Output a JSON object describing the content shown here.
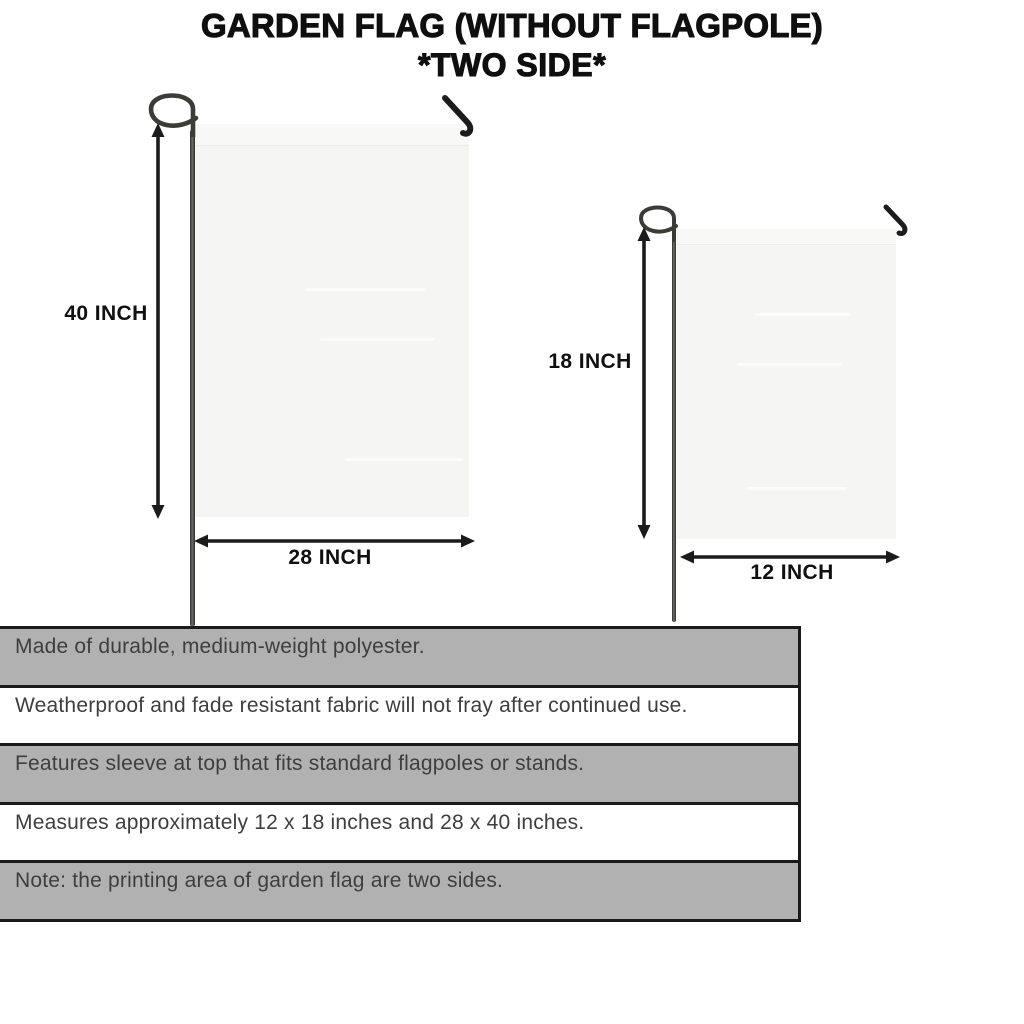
{
  "title": {
    "line1": "GARDEN FLAG (WITHOUT FLAGPOLE)",
    "line2": "*TWO SIDE*"
  },
  "flags": {
    "large": {
      "height_label": "40 INCH",
      "width_label": "28 INCH"
    },
    "small": {
      "height_label": "18 INCH",
      "width_label": "12 INCH"
    }
  },
  "features": [
    "Made of durable, medium-weight polyester.",
    "Weatherproof and fade resistant fabric will not fray after continued use.",
    "Features sleeve at top that fits standard flagpoles or stands.",
    "Measures approximately 12 x 18 inches and 28 x 40 inches.",
    "Note: the printing area of garden flag are two sides."
  ],
  "colors": {
    "stripe_gray": "#b2b1b1",
    "flag_fill": "#f5f5f4",
    "ink": "#1a1a1a",
    "feature_text": "#3e3e3e"
  }
}
